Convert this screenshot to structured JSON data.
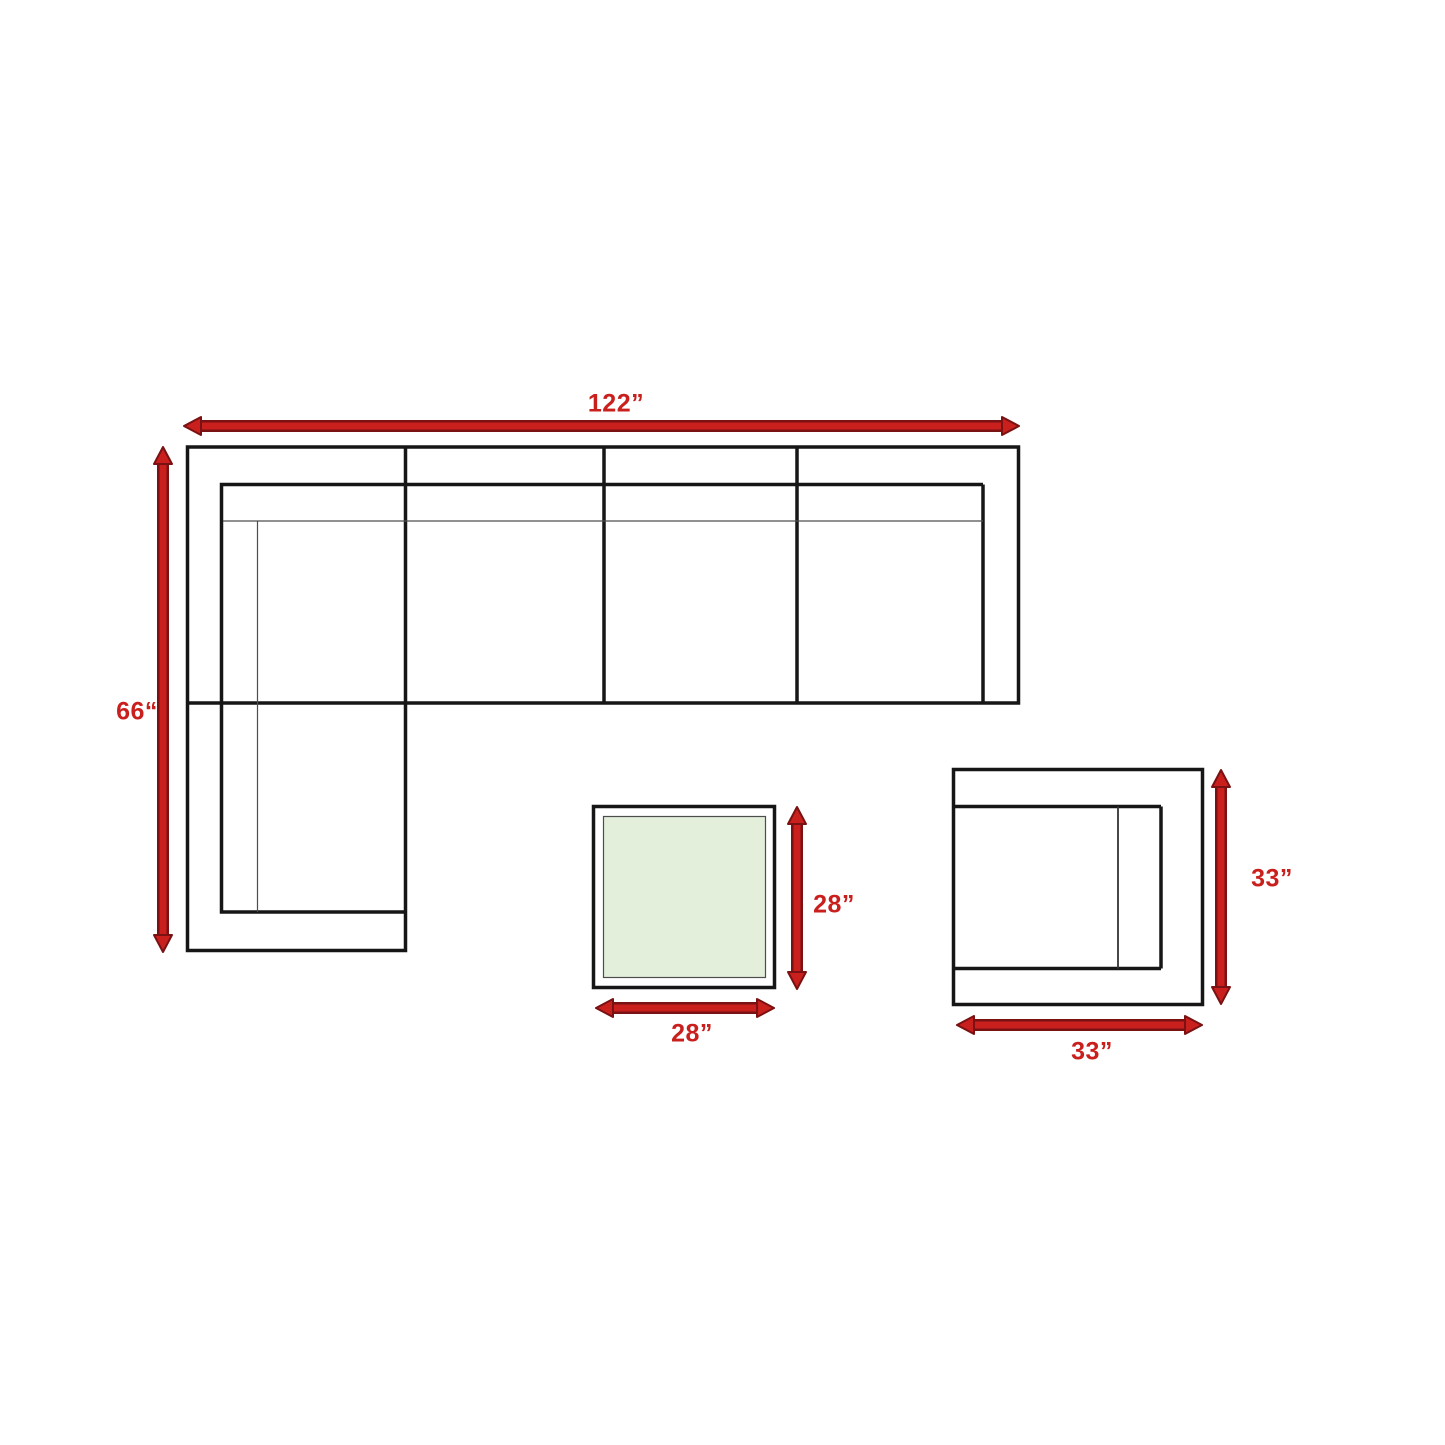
{
  "diagram": {
    "type": "furniture-dimension-diagram",
    "colors": {
      "arrow_red": "#c9201e",
      "arrow_dark": "#7a1112",
      "outline_black": "#161616",
      "thin_line": "#4d4d4d",
      "glass_green": "#e3efdb",
      "canvas_white": "#ffffff"
    },
    "sectional_sofa": {
      "width_label": "122”",
      "depth_label": "66“"
    },
    "coffee_table": {
      "depth_label": "28”",
      "width_label": "28”"
    },
    "lounge_chair": {
      "depth_label": "33”",
      "width_label": "33”"
    }
  }
}
